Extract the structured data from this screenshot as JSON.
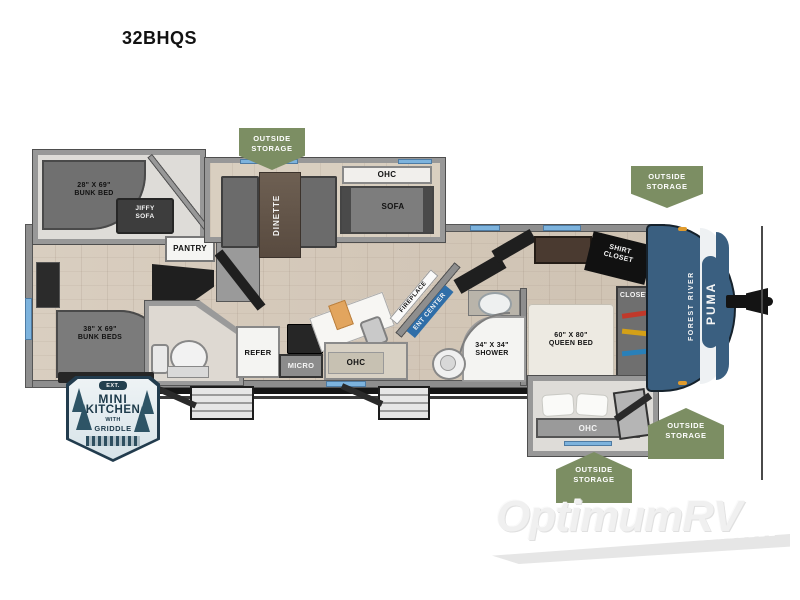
{
  "page": {
    "title": "32BHQS"
  },
  "colors": {
    "badge_green": "#7c8e63",
    "cap_blue": "#3a5f80",
    "ent_blue": "#2f6ea8",
    "window_blue": "#7db3dd"
  },
  "badges": {
    "outside_storage": [
      {
        "line1": "OUTSIDE",
        "line2": "STORAGE"
      },
      {
        "line1": "OUTSIDE",
        "line2": "STORAGE"
      },
      {
        "line1": "OUTSIDE",
        "line2": "STORAGE"
      },
      {
        "line1": "OUTSIDE",
        "line2": "STORAGE"
      }
    ],
    "exterior_kitchen": {
      "tag": "EXT.",
      "word1": "MINI",
      "word2": "KITCHEN",
      "word3": "WITH",
      "word4": "GRIDDLE"
    }
  },
  "rooms": {
    "bunk_slide": {
      "size": "28\" X 69\"",
      "name": "BUNK BED"
    },
    "jiffy_sofa": {
      "line1": "JIFFY",
      "line2": "SOFA"
    },
    "pantry": {
      "label": "PANTRY"
    },
    "dinette": {
      "label": "DINETTE",
      "ohc": "OHC"
    },
    "sofa": {
      "label": "SOFA"
    },
    "bunk_wall": {
      "size": "38\" X 69\"",
      "name": "BUNK BEDS"
    },
    "kitchen": {
      "refer": "REFER",
      "micro": "MICRO",
      "ohc": "OHC"
    },
    "living": {
      "fireplace": "FIREPLACE",
      "ent_center": "ENT CENTER"
    },
    "bath": {
      "size": "34\" X 34\"",
      "name": "SHOWER"
    },
    "bedroom": {
      "bed_size": "60\" X 80\"",
      "bed_name": "QUEEN BED",
      "ohc": "OHC",
      "shirt_closet_line1": "SHIRT",
      "shirt_closet_line2": "CLOSET",
      "closet": "CLOSET"
    }
  },
  "cap": {
    "brand": "FOREST RIVER",
    "model": "PUMA"
  },
  "watermark": {
    "text": "OptimumRV"
  }
}
